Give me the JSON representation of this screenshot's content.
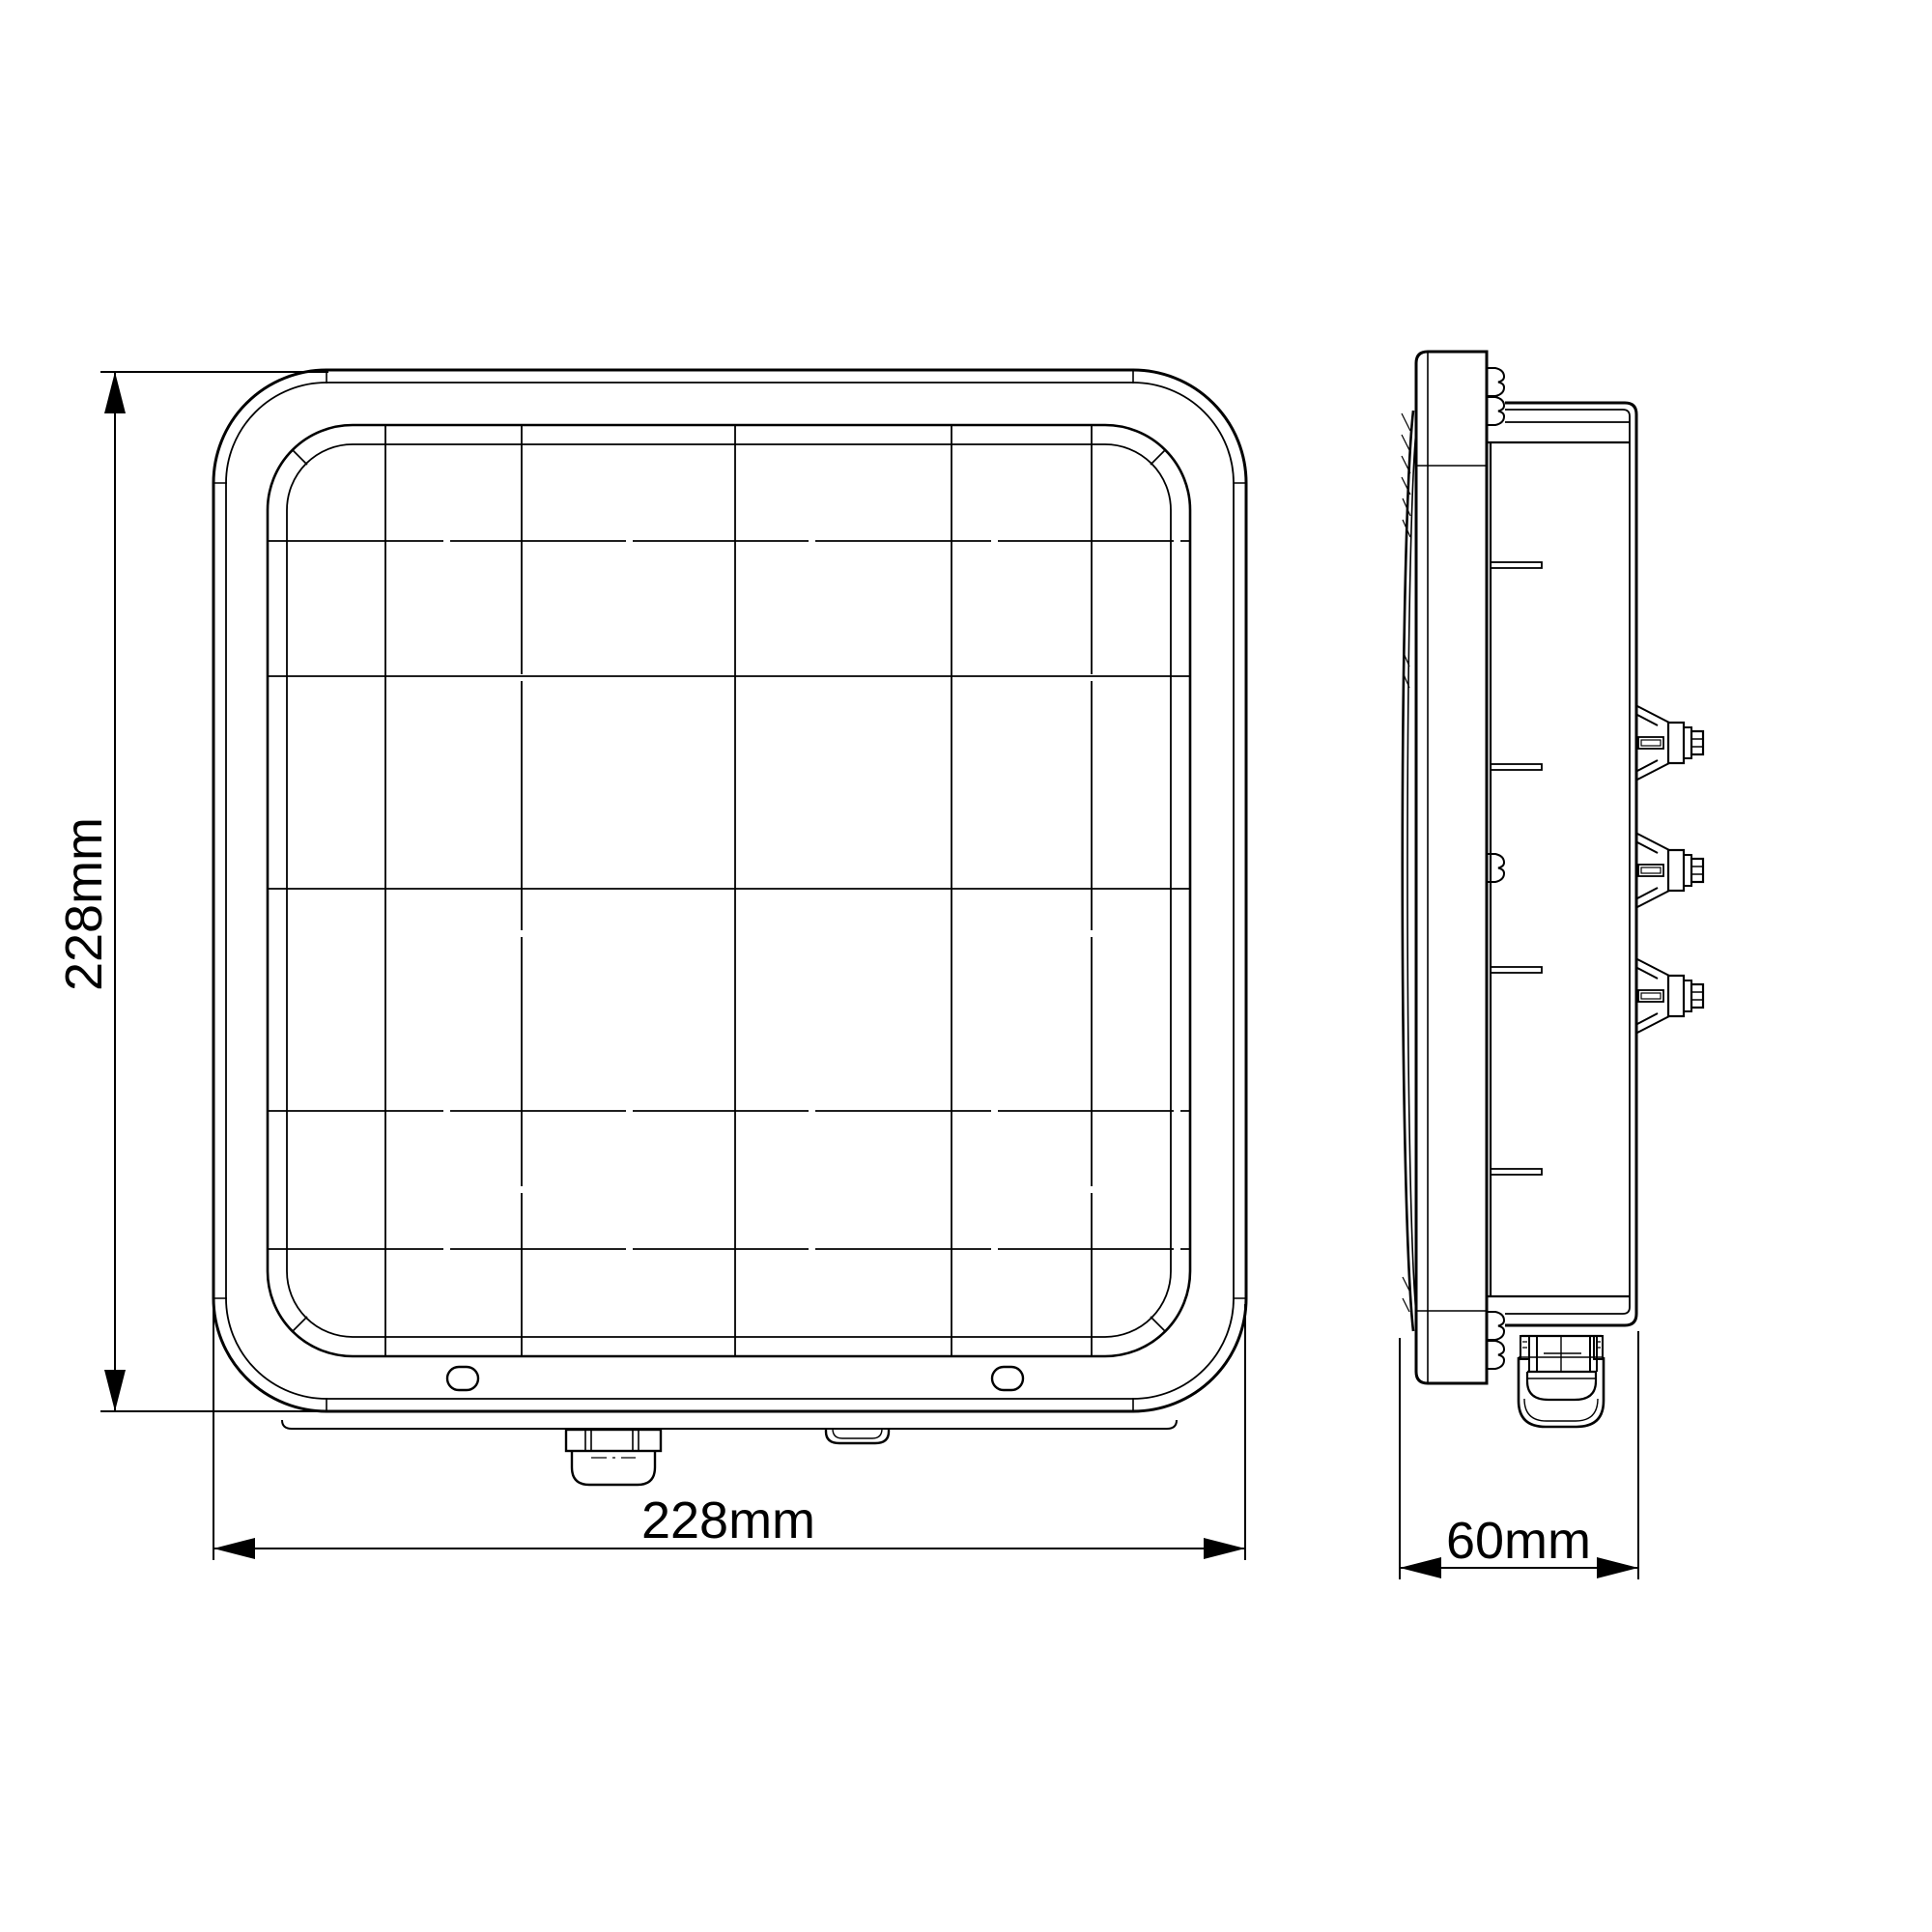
{
  "drawing": {
    "dimensions": {
      "front_width": "228mm",
      "front_height": "228mm",
      "side_depth": "60mm"
    },
    "colors": {
      "line": "#000000",
      "background": "#ffffff"
    }
  }
}
